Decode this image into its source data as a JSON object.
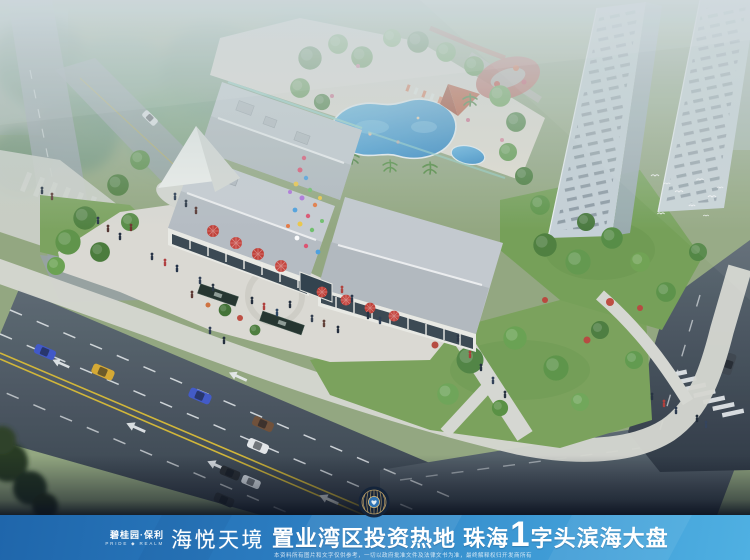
{
  "banner": {
    "brand_line1": "碧桂园·保利",
    "brand_line2": "PRIDE ◆ REALM",
    "project_name": "海悦天境",
    "headline_part1": "置业湾区投资热地 珠海",
    "headline_number": "1",
    "headline_part2": "字头滨海大盘",
    "disclaimer": "本资料所有图片和文字仅供参考，一切以政府批准文件及法律文书为准，最终解释权归开发商所有",
    "colors": {
      "banner_left": "#1f66ab",
      "banner_right": "#4fb0e2",
      "text": "#ffffff"
    }
  },
  "scene": {
    "badge_icon": "project-seal",
    "subject": "aerial-rendering-of-commercial-complex",
    "accent_colors": {
      "pool_water": "#2a8fd0",
      "umbrellas": "#c23a33",
      "roofs": "#c6cbd0",
      "asphalt": "#434d59",
      "lawn": "#7aa258"
    }
  }
}
